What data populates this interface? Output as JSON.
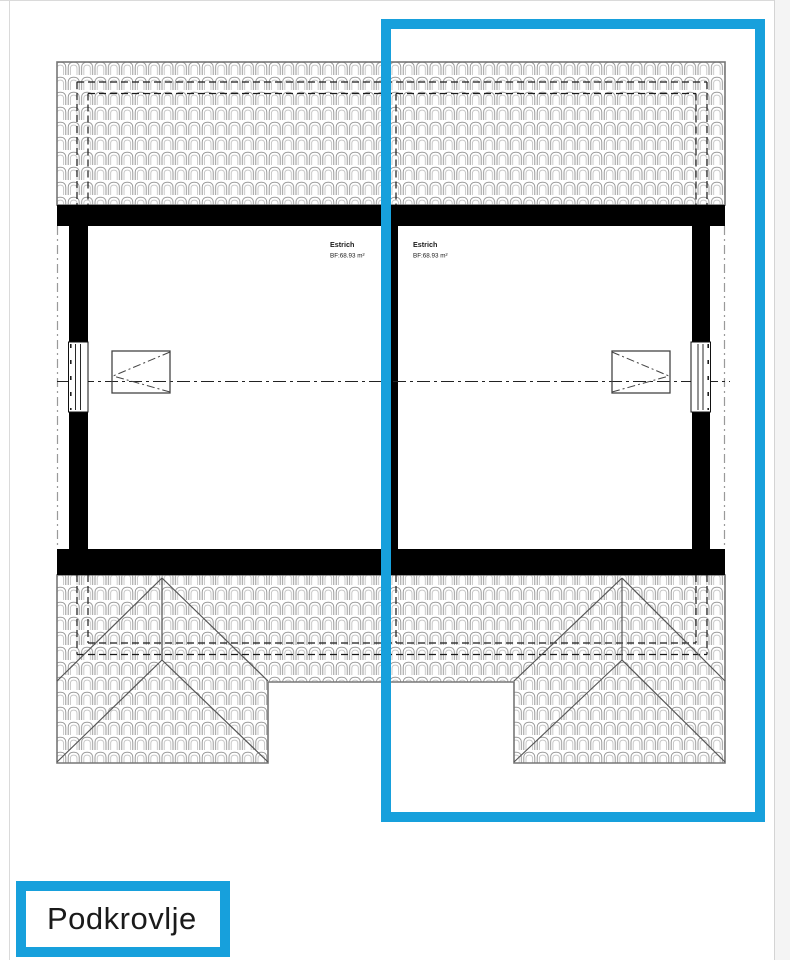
{
  "page": {
    "background": "#ffffff",
    "border_color": "#dadada",
    "gutter_color": "#f4f4f4"
  },
  "highlight": {
    "color": "#17A0DC",
    "shape": "rectangle-outline-over-right-unit"
  },
  "floor_label": {
    "text": "Podkrovlje"
  },
  "plan": {
    "type": "attic-floor-plan-duplex",
    "left_unit": {
      "room_name": "Estrich",
      "room_area": "BF:68.93 m²"
    },
    "right_unit": {
      "room_name": "Estrich",
      "room_area": "BF:68.93 m²"
    }
  }
}
